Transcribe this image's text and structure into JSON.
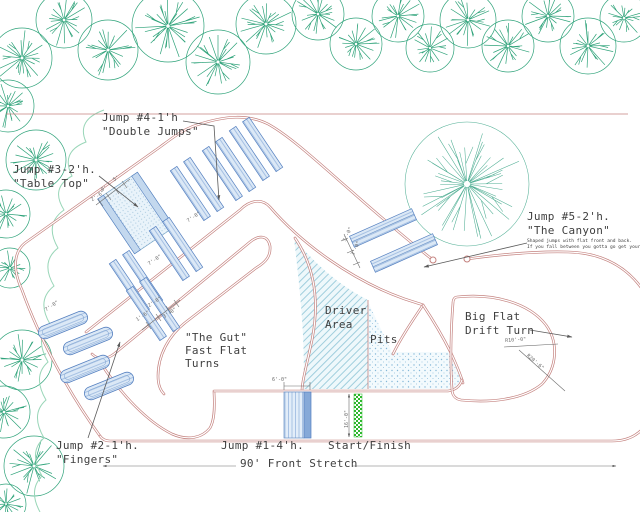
{
  "drawing": {
    "labels": {
      "jump4": {
        "line1": "Jump #4-1'h",
        "line2": "\"Double Jumps\""
      },
      "jump3": {
        "line1": "Jump #3-2'h.",
        "line2": "\"Table Top\""
      },
      "jump5": {
        "line1": "Jump #5-2'h.",
        "line2": "\"The Canyon\"",
        "note1": "Shaped jumps with flat front and back.",
        "note2": "If you fall between you gotta go get your truck."
      },
      "gut": {
        "line1": "\"The Gut\"",
        "line2": "Fast Flat",
        "line3": "Turns"
      },
      "driver": {
        "line1": "Driver",
        "line2": "Area"
      },
      "pits": "Pits",
      "big_flat": {
        "line1": "Big Flat",
        "line2": "Drift Turn"
      },
      "jump2": {
        "line1": "Jump #2-1'h.",
        "line2": "\"Fingers\""
      },
      "jump1": "Jump #1-4'h.",
      "start_finish": "Start/Finish",
      "front_stretch": "90' Front Stretch"
    },
    "dimensions": [
      "7'-0\"",
      "7'-0\"",
      "7'-0\"",
      "2'-6\"",
      "5'",
      "9'",
      "2'-0\"",
      "3'-0\"",
      "1'-6\"",
      "5'-0\"",
      "3'-0\"",
      "6'-0\"",
      "16'-0\"",
      "R10'-0\"",
      "R20'-6\""
    ],
    "colors": {
      "track_line": "#c4827f",
      "tree_line": "#2fa37a",
      "big_tree_line": "#4fae93",
      "canopy_line": "#99d6b8",
      "jump_edge": "#5580c0",
      "start_finish_green": "#2eb82e",
      "label_text": "#3f3f3f",
      "dimension_text": "#6b6b6b"
    }
  }
}
